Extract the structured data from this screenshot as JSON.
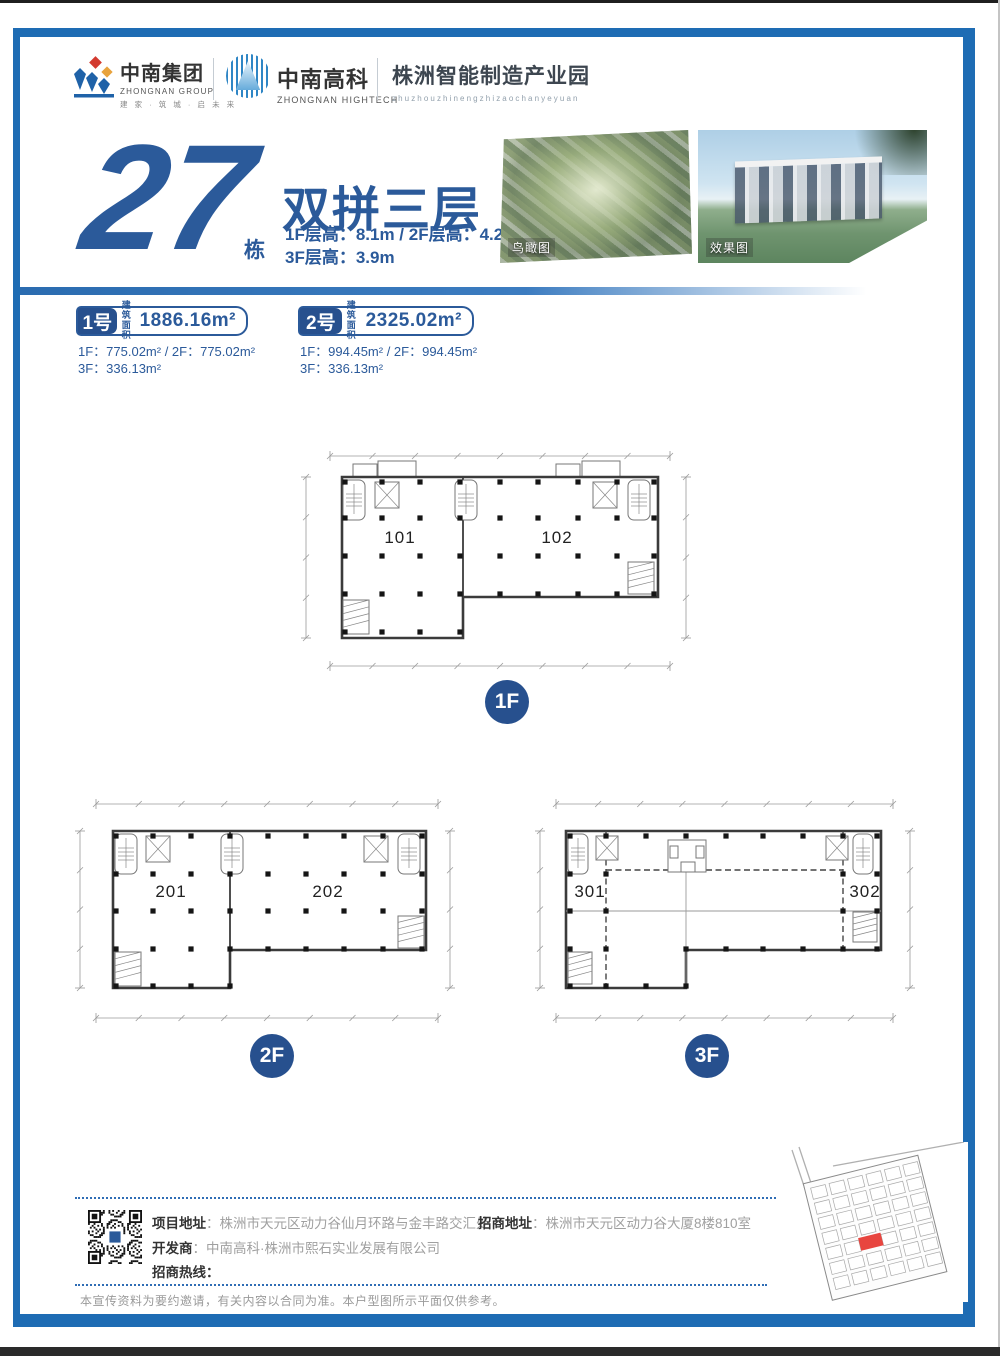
{
  "header": {
    "group": {
      "name": "中南集团",
      "en": "ZHONGNAN GROUP",
      "tagline": "建 家 · 筑 城 · 启 未 来"
    },
    "hightech": {
      "name": "中南高科",
      "en": "ZHONGNAN HIGHTECH"
    },
    "park": {
      "name": "株洲智能制造产业园",
      "pinyin": "zhuzhouzhinengzhizaochanyeyuan"
    }
  },
  "hero": {
    "number": "27",
    "suffix": "栋",
    "type_title": "双拼三层",
    "heights_line1": "1F层高：8.1m / 2F层高：4.2m",
    "heights_line2": "3F层高：3.9m",
    "aerial_label": "鸟瞰图",
    "render_label": "效果图"
  },
  "units": [
    {
      "badge": "1号",
      "area_word_1": "建筑",
      "area_word_2": "面积",
      "total": "1886.16m²",
      "line1": "1F：775.02m² / 2F：775.02m²",
      "line2": "3F：336.13m²"
    },
    {
      "badge": "2号",
      "area_word_1": "建筑",
      "area_word_2": "面积",
      "total": "2325.02m²",
      "line1": "1F：994.45m² / 2F：994.45m²",
      "line2": "3F：336.13m²"
    }
  ],
  "plans": {
    "f1": {
      "badge": "1F",
      "room_left": "101",
      "room_right": "102"
    },
    "f2": {
      "badge": "2F",
      "room_left": "201",
      "room_right": "202"
    },
    "f3": {
      "badge": "3F",
      "room_left": "301",
      "room_right": "302"
    }
  },
  "footer": {
    "project_label": "项目地址",
    "project_value": "：株洲市天元区动力谷仙月环路与金丰路交汇处",
    "leasing_label": "招商地址",
    "leasing_value": "：株洲市天元区动力谷大厦8楼810室",
    "developer_label": "开发商",
    "developer_value": "：中南高科·株洲市熙石实业发展有限公司",
    "hotline_label": "招商热线：",
    "disclaimer": "本宣传资料为要约邀请，有关内容以合同为准。本户型图所示平面仅供参考。"
  },
  "colors": {
    "frame": "#1e6cb4",
    "accent": "#2b5a9a",
    "badge": "#27508e",
    "highlight_red": "#e8453f"
  }
}
